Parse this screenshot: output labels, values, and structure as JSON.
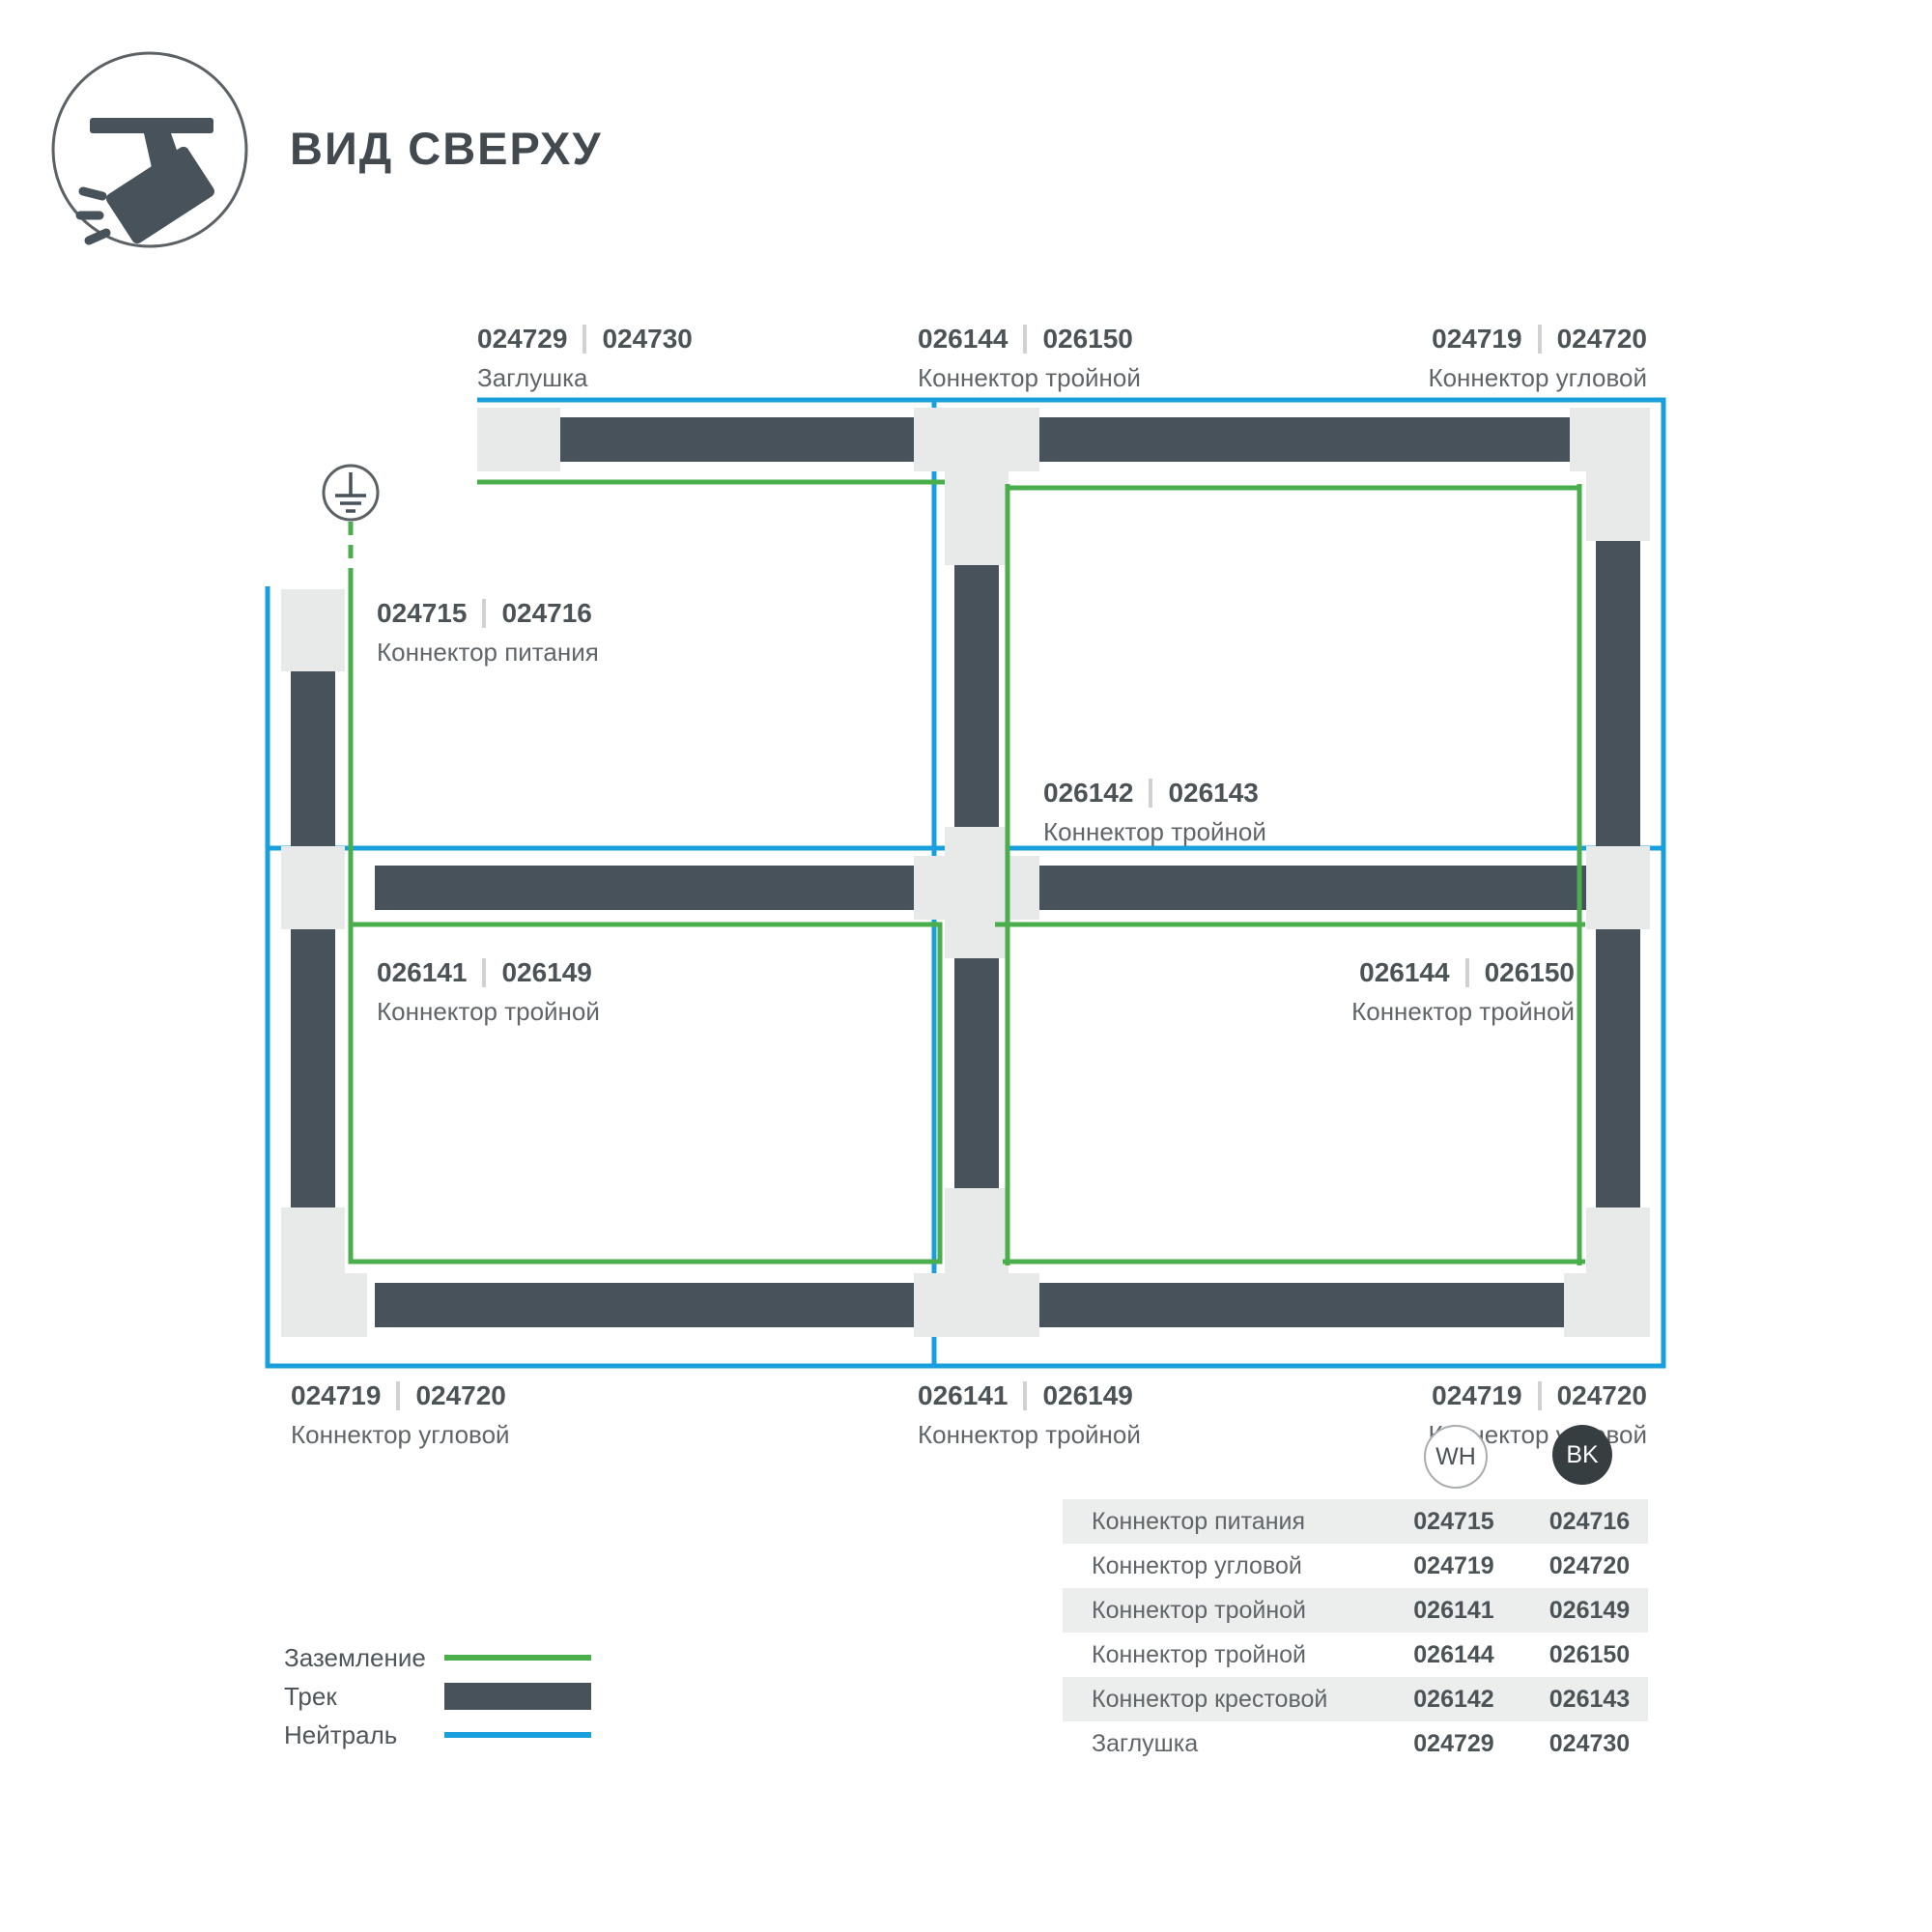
{
  "header": {
    "title": "ВИД СВЕРХУ",
    "icon": "ceiling-track-spotlight-icon"
  },
  "diagram": {
    "ground_symbol_icon": "earth-ground-icon",
    "callouts": [
      {
        "code_wh": "024729",
        "code_bk": "024730",
        "name": "Заглушка"
      },
      {
        "code_wh": "026144",
        "code_bk": "026150",
        "name": "Коннектор тройной"
      },
      {
        "code_wh": "024719",
        "code_bk": "024720",
        "name": "Коннектор угловой"
      },
      {
        "code_wh": "024715",
        "code_bk": "024716",
        "name": "Коннектор питания"
      },
      {
        "code_wh": "026142",
        "code_bk": "026143",
        "name": "Коннектор тройной"
      },
      {
        "code_wh": "026141",
        "code_bk": "026149",
        "name": "Коннектор тройной"
      },
      {
        "code_wh": "026144",
        "code_bk": "026150",
        "name": "Коннектор тройной"
      },
      {
        "code_wh": "024719",
        "code_bk": "024720",
        "name": "Коннектор угловой"
      },
      {
        "code_wh": "026141",
        "code_bk": "026149",
        "name": "Коннектор тройной"
      },
      {
        "code_wh": "024719",
        "code_bk": "024720",
        "name": "Коннектор угловой"
      }
    ]
  },
  "legend": {
    "items": [
      {
        "label": "Заземление",
        "swatch": "ground-line"
      },
      {
        "label": "Трек",
        "swatch": "track-bar"
      },
      {
        "label": "Нейтраль",
        "swatch": "neutral-line"
      }
    ]
  },
  "table": {
    "col_wh": "WH",
    "col_bk": "BK",
    "rows": [
      {
        "name": "Коннектор питания",
        "wh": "024715",
        "bk": "024716"
      },
      {
        "name": "Коннектор угловой",
        "wh": "024719",
        "bk": "024720"
      },
      {
        "name": "Коннектор тройной",
        "wh": "026141",
        "bk": "026149"
      },
      {
        "name": "Коннектор тройной",
        "wh": "026144",
        "bk": "026150"
      },
      {
        "name": "Коннектор крестовой",
        "wh": "026142",
        "bk": "026143"
      },
      {
        "name": "Заглушка",
        "wh": "024729",
        "bk": "024730"
      }
    ]
  },
  "colors": {
    "track": "#47525A",
    "block": "#E8EAEA",
    "ground": "#4BAE4C",
    "neutral": "#19A0DC",
    "num": "#4B5357",
    "name": "#5F6569",
    "sep": "#CFD2D3",
    "table-alt": "#ECEDED",
    "bk-fill": "#363E42",
    "symbol": "#5B6165"
  }
}
